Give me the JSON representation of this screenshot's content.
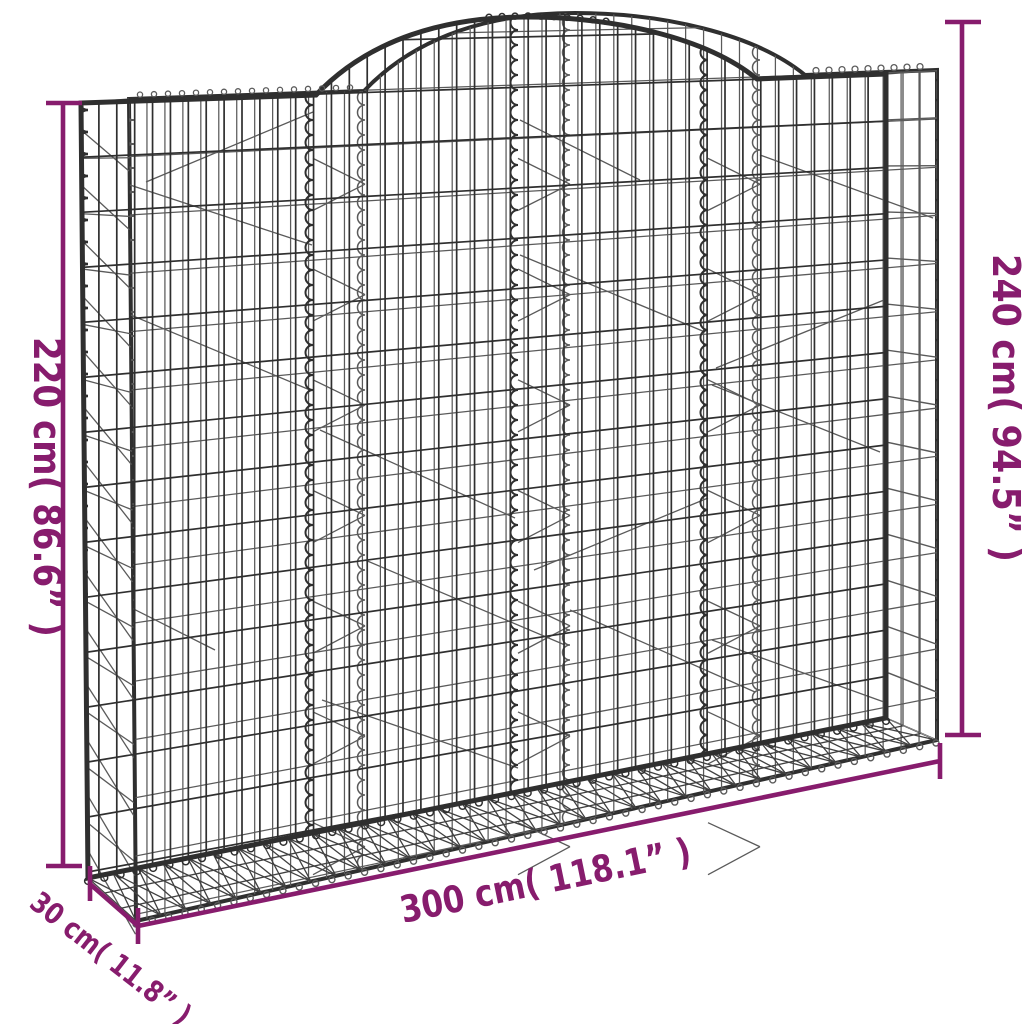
{
  "colors": {
    "background": "#ffffff",
    "accent": "#871c6d",
    "wire": "#2f2f2f",
    "wire_light": "#5a5a5a",
    "base_wire": "#404040"
  },
  "diagram": {
    "subject": "Arched gabion wire-mesh basket — dimension drawing",
    "dimensions": {
      "height_left": {
        "label": "220 cm( 86.6” )",
        "cm": 220,
        "inches": 86.6
      },
      "height_right": {
        "label": "240 cm( 94.5” )",
        "cm": 240,
        "inches": 94.5
      },
      "width": {
        "label": "300 cm( 118.1” )",
        "cm": 300,
        "inches": 118.1
      },
      "depth": {
        "label": "30 cm( 11.8” )",
        "cm": 30,
        "inches": 11.8
      }
    }
  }
}
